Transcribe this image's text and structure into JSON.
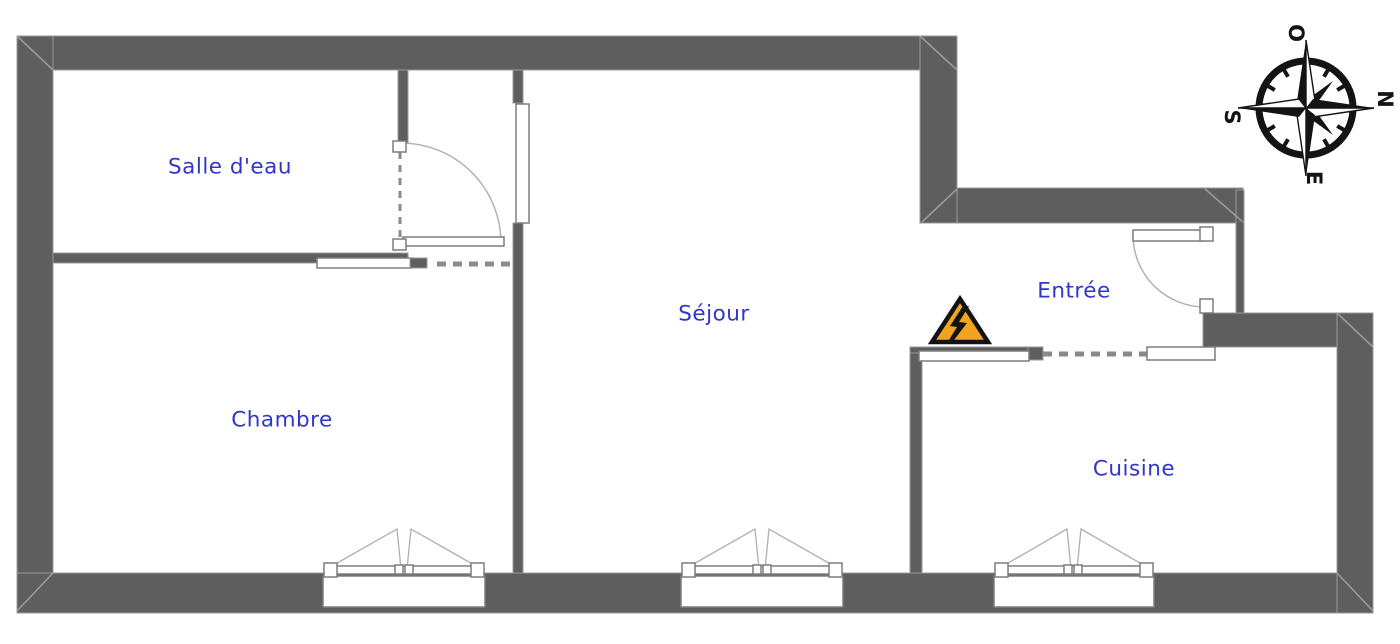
{
  "plan": {
    "type": "apartment-floor-plan",
    "language": "fr"
  },
  "rooms": {
    "salle_deau": "Salle d'eau",
    "chambre": "Chambre",
    "sejour": "Séjour",
    "entree": "Entrée",
    "cuisine": "Cuisine"
  },
  "compass": {
    "west": "O",
    "north": "N",
    "east": "E",
    "south": "S"
  },
  "icons": {
    "warning": "electrical-hazard-triangle",
    "compass": "compass-rose"
  },
  "colors": {
    "wall": "#5e5e5e",
    "wall_edge": "#9a9a9a",
    "label": "#3136c9",
    "dash": "#8a8a8a",
    "fixture": "#7d7d7d",
    "warning_fill": "#f0a41f",
    "warning_border": "#121212",
    "compass_ink": "#141414"
  }
}
